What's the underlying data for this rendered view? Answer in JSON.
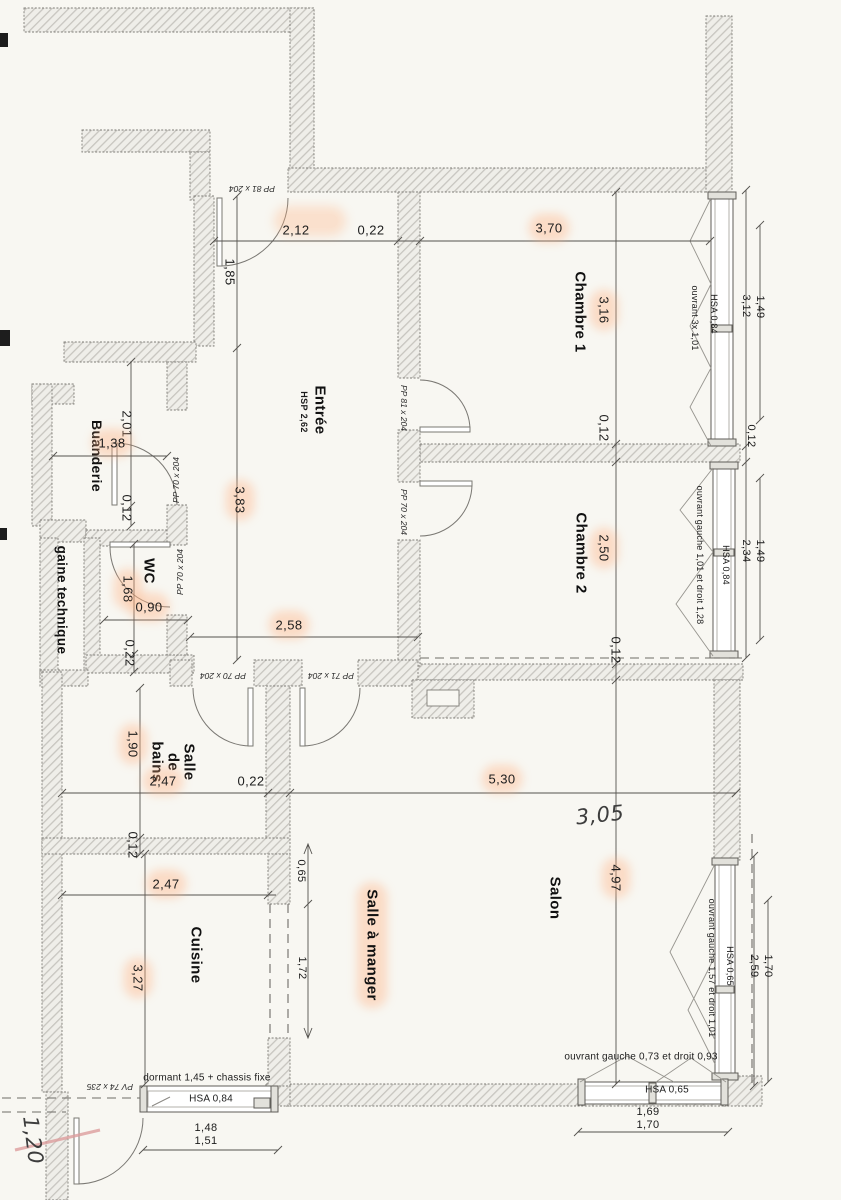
{
  "rooms": {
    "entree": "Entrée",
    "entree_hsp": "HSP 2,62",
    "chambre1": "Chambre 1",
    "chambre2": "Chambre 2",
    "salon": "Salon",
    "salle_a_manger": "Salle à manger",
    "cuisine": "Cuisine",
    "salle_de_bains": "Salle de bains",
    "wc": "WC",
    "buanderie": "Buanderie",
    "gaine": "gaine technique"
  },
  "dims": {
    "d_2_12": "2,12",
    "d_0_22a": "0,22",
    "d_3_70": "3,70",
    "d_1_85": "1,85",
    "d_3_83": "3,83",
    "d_3_16": "3,16",
    "d_0_12_c1": "0,12",
    "d_2_50": "2,50",
    "d_0_12_sal": "0,12",
    "d_2_58": "2,58",
    "d_2_01": "2,01",
    "d_1_38": "1,38",
    "d_0_12_bu": "0,12",
    "d_1_68": "1,68",
    "d_0_90": "0,90",
    "d_0_22_g": "0,22",
    "d_1_90": "1,90",
    "d_0_12_sdb": "0,12",
    "d_2_47_sdb": "2,47",
    "d_0_22_b": "0,22",
    "d_5_30": "5,30",
    "d_4_97": "4,97",
    "d_2_47_cui": "2,47",
    "d_3_27": "3,27",
    "d_0_65": "0,65",
    "d_1_72": "1,72",
    "d_3_12": "3,12",
    "d_1_49_c1": "1,49",
    "d_0_12_w": "0,12",
    "d_2_34": "2,34",
    "d_1_49_c2": "1,49",
    "d_2_59": "2,59",
    "d_1_70_se": "1,70",
    "d_1_69": "1,69",
    "d_1_70_ss": "1,70",
    "d_1_48": "1,48",
    "d_1_51": "1,51"
  },
  "doors": {
    "entrance": "PP 81 x 204",
    "chambre1": "PP 81 x 204",
    "chambre2": "PP 70 x 204",
    "buanderie": "PP 70 x 204",
    "wc": "PP 70 x 204",
    "sdb": "PP 70 x 204",
    "sam": "PP 71 x 204",
    "loggia": "PV 74 x 235"
  },
  "windows": {
    "chambre1": {
      "hsa": "HSA 0,84",
      "ouvrant": "ouvrant 3x 1,01"
    },
    "chambre2": {
      "hsa": "HSA 0,84",
      "ouvrant": "ouvrant gauche 1,01 et droit 1,28"
    },
    "salon_est": {
      "hsa": "HSA 0,65",
      "ouvrant": "ouvrant gauche 1,57 et droit 1,01"
    },
    "salon_sud": {
      "hsa": "HSA 0,65",
      "ouvrant": "ouvrant gauche 0,73 et droit 0,93"
    },
    "cuisine": {
      "hsa": "HSA 0,84",
      "dormant": "dormant 1,45 + chassis fixe"
    }
  },
  "notes": {
    "hand_305": "3,05",
    "hand_120": "1,20"
  }
}
